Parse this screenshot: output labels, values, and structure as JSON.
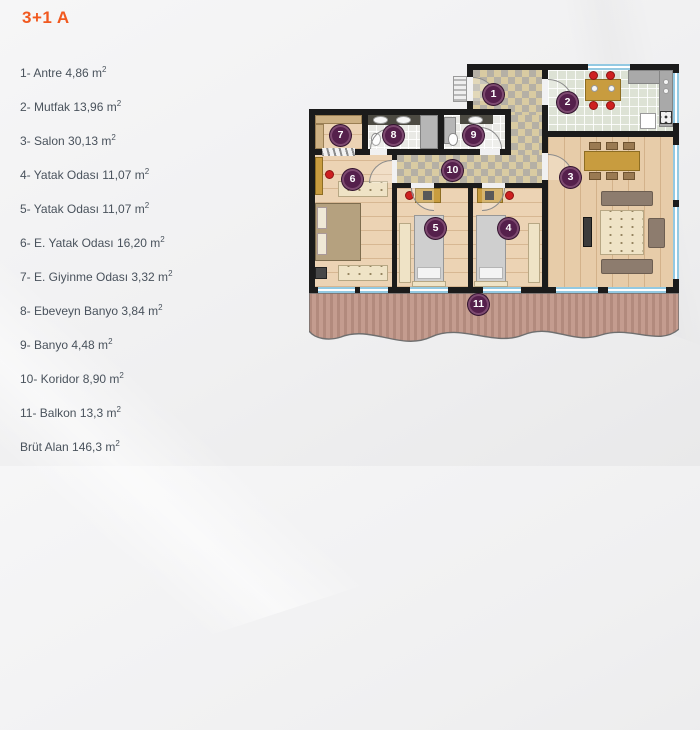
{
  "title": {
    "text": "3+1 A"
  },
  "legend": {
    "items": [
      {
        "text": "1- Antre 4,86 m",
        "sup": "2"
      },
      {
        "text": "2- Mutfak 13,96 m",
        "sup": "2"
      },
      {
        "text": "3- Salon 30,13 m",
        "sup": "2"
      },
      {
        "text": "4- Yatak Odası 11,07 m",
        "sup": "2"
      },
      {
        "text": "5- Yatak Odası 11,07 m",
        "sup": "2"
      },
      {
        "text": "6- E. Yatak Odası 16,20 m",
        "sup": "2"
      },
      {
        "text": "7- E. Giyinme Odası 3,32 m",
        "sup": "2"
      },
      {
        "text": "8- Ebeveyn Banyo 3,84 m",
        "sup": "2"
      },
      {
        "text": "9- Banyo 4,48 m",
        "sup": "2"
      },
      {
        "text": "10- Koridor 8,90 m",
        "sup": "2"
      },
      {
        "text": "11- Balkon 13,3 m",
        "sup": "2"
      },
      {
        "text": "Brüt Alan 146,3 m",
        "sup": "2"
      }
    ]
  },
  "plan": {
    "markers": [
      "1",
      "2",
      "3",
      "4",
      "5",
      "6",
      "7",
      "8",
      "9",
      "10",
      "11"
    ]
  },
  "colors": {
    "title_orange": "#f1591f",
    "legend_text": "#49525c",
    "marker_plum": "#55204c",
    "wall_black": "#1b1b1b",
    "window_blue": "#93c9e2",
    "balcony_rose": "#c49c8f",
    "accent_red": "#ce2020"
  }
}
